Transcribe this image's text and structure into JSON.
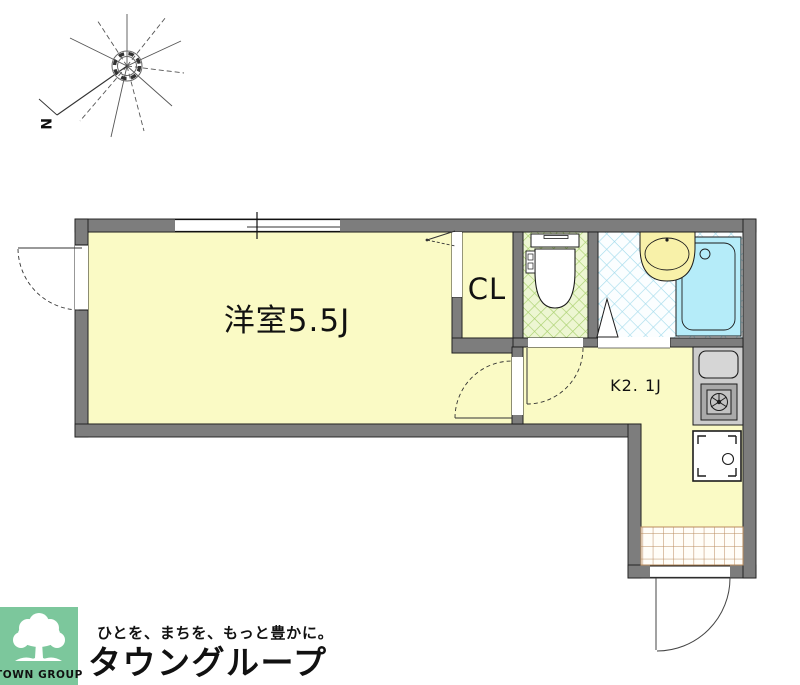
{
  "compass": {
    "north": "N"
  },
  "plan": {
    "rooms": {
      "living": {
        "label": "洋室5.5J"
      },
      "closet": {
        "label": "CL"
      },
      "kitchen": {
        "label": "K2. 1J"
      }
    },
    "fixtures": [
      "toilet",
      "bathtub",
      "washbasin",
      "kitchen-sink",
      "gas-stove",
      "washing-machine",
      "entrance-tiles"
    ]
  },
  "footer": {
    "logo_text": "TOWN GROUP",
    "tagline": "ひとを、まちを、もっと豊かに。",
    "company": "タウングループ"
  },
  "colors": {
    "wall": "#7d7d7d",
    "room_yellow": "#fafac5",
    "toilet_floor": "#edf6d2",
    "toilet_lattice": "#a8d06d",
    "bath_floor": "#fbfeff",
    "bath_lattice": "#a6dcec",
    "bathtub": "#b5ecf9",
    "washbasin": "#f8f1a9",
    "counter": "#cccccc",
    "tile_line": "#b98a5c",
    "logo_green": "#7cc79c",
    "company_green": "#6fc495"
  }
}
